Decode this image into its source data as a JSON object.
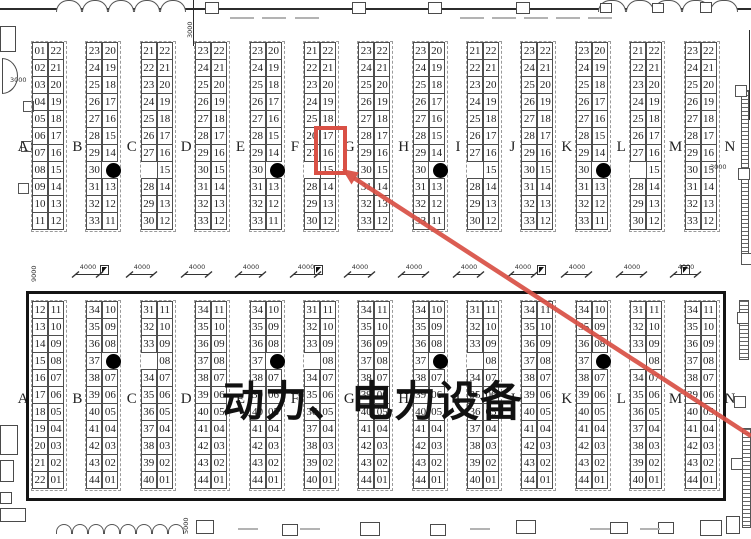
{
  "title": "动力、电力设备",
  "colors": {
    "highlight_red": "#d95045",
    "line_black": "#141414"
  },
  "row_letters": [
    "A",
    "B",
    "C",
    "D",
    "E",
    "F",
    "G",
    "H",
    "I",
    "J",
    "K",
    "L",
    "M",
    "N"
  ],
  "aisle": {
    "ramp_label": "4000",
    "ramp_count": 12
  },
  "dimension_labels": {
    "top_left_vertical": "3000",
    "left_wall": "3000",
    "left_height_vertical": "9000",
    "right_wall": "3000",
    "bottom_vertical": "5000"
  },
  "highlight": {
    "section": "top",
    "column_index": 6,
    "side": "right",
    "rows": [
      6,
      7
    ],
    "booths": [
      "17",
      "16"
    ]
  },
  "top_section": {
    "columns": [
      {
        "left": [
          "01",
          "02",
          "03",
          "04",
          "05",
          "06",
          "07",
          "08",
          "09",
          "10",
          "11"
        ],
        "right": [
          "22",
          "21",
          "20",
          "19",
          "18",
          "17",
          "16",
          "15",
          "14",
          "13",
          "12"
        ]
      },
      {
        "left": [
          "23",
          "24",
          "25",
          "26",
          "27",
          "28",
          "29",
          "30",
          "31",
          "32",
          "33"
        ],
        "right": [
          "20",
          "19",
          "18",
          "17",
          "16",
          "15",
          "14",
          "dot",
          "13",
          "12",
          "11"
        ]
      },
      {
        "left": [
          "21",
          "22",
          "23",
          "24",
          "25",
          "26",
          "27",
          "",
          "28",
          "29",
          "30"
        ],
        "right": [
          "22",
          "21",
          "20",
          "19",
          "18",
          "17",
          "16",
          "15",
          "14",
          "13",
          "12"
        ]
      },
      {
        "left": [
          "23",
          "24",
          "25",
          "26",
          "27",
          "28",
          "29",
          "30",
          "31",
          "32",
          "33"
        ],
        "right": [
          "22",
          "21",
          "20",
          "19",
          "18",
          "17",
          "16",
          "15",
          "14",
          "13",
          "12"
        ]
      },
      {
        "left": [
          "23",
          "24",
          "25",
          "26",
          "27",
          "28",
          "29",
          "30",
          "31",
          "32",
          "33"
        ],
        "right": [
          "20",
          "19",
          "18",
          "17",
          "16",
          "15",
          "14",
          "dot",
          "13",
          "12",
          "11"
        ]
      },
      {
        "left": [
          "21",
          "22",
          "23",
          "24",
          "25",
          "26",
          "27",
          "",
          "28",
          "29",
          "30"
        ],
        "right": [
          "22",
          "21",
          "20",
          "19",
          "18",
          "17",
          "16",
          "15",
          "14",
          "13",
          "12"
        ]
      },
      {
        "left": [
          "23",
          "24",
          "25",
          "26",
          "27",
          "28",
          "29",
          "30",
          "31",
          "32",
          "33"
        ],
        "right": [
          "22",
          "21",
          "20",
          "19",
          "18",
          "17",
          "16",
          "15",
          "14",
          "13",
          "12"
        ]
      },
      {
        "left": [
          "23",
          "24",
          "25",
          "26",
          "27",
          "28",
          "29",
          "30",
          "31",
          "32",
          "33"
        ],
        "right": [
          "20",
          "19",
          "18",
          "17",
          "16",
          "15",
          "14",
          "dot",
          "13",
          "12",
          "11"
        ]
      },
      {
        "left": [
          "21",
          "22",
          "23",
          "24",
          "25",
          "26",
          "27",
          "",
          "28",
          "29",
          "30"
        ],
        "right": [
          "22",
          "21",
          "20",
          "19",
          "18",
          "17",
          "16",
          "15",
          "14",
          "13",
          "12"
        ]
      },
      {
        "left": [
          "23",
          "24",
          "25",
          "26",
          "27",
          "28",
          "29",
          "30",
          "31",
          "32",
          "33"
        ],
        "right": [
          "22",
          "21",
          "20",
          "19",
          "18",
          "17",
          "16",
          "15",
          "14",
          "13",
          "12"
        ]
      },
      {
        "left": [
          "23",
          "24",
          "25",
          "26",
          "27",
          "28",
          "29",
          "30",
          "31",
          "32",
          "33"
        ],
        "right": [
          "20",
          "19",
          "18",
          "17",
          "16",
          "15",
          "14",
          "dot",
          "13",
          "12",
          "11"
        ]
      },
      {
        "left": [
          "21",
          "22",
          "23",
          "24",
          "25",
          "26",
          "27",
          "",
          "28",
          "29",
          "30"
        ],
        "right": [
          "22",
          "21",
          "20",
          "19",
          "18",
          "17",
          "16",
          "15",
          "14",
          "13",
          "12"
        ]
      },
      {
        "left": [
          "23",
          "24",
          "25",
          "26",
          "27",
          "28",
          "29",
          "30",
          "31",
          "32",
          "33"
        ],
        "right": [
          "22",
          "21",
          "20",
          "19",
          "18",
          "17",
          "16",
          "15",
          "14",
          "13",
          "12"
        ]
      }
    ]
  },
  "bottom_section": {
    "columns": [
      {
        "left": [
          "12",
          "13",
          "14",
          "15",
          "16",
          "17",
          "18",
          "19",
          "20",
          "21",
          "22"
        ],
        "right": [
          "11",
          "10",
          "09",
          "08",
          "07",
          "06",
          "05",
          "04",
          "03",
          "02",
          "01"
        ]
      },
      {
        "left": [
          "34",
          "35",
          "36",
          "37",
          "38",
          "39",
          "40",
          "41",
          "42",
          "43",
          "44"
        ],
        "right": [
          "10",
          "09",
          "08",
          "dot",
          "07",
          "06",
          "05",
          "04",
          "03",
          "02",
          "01"
        ]
      },
      {
        "left": [
          "31",
          "32",
          "33",
          "",
          "34",
          "35",
          "36",
          "37",
          "38",
          "39",
          "40"
        ],
        "right": [
          "11",
          "10",
          "09",
          "08",
          "07",
          "06",
          "05",
          "04",
          "03",
          "02",
          "01"
        ]
      },
      {
        "left": [
          "34",
          "35",
          "36",
          "37",
          "38",
          "39",
          "40",
          "41",
          "42",
          "43",
          "44"
        ],
        "right": [
          "11",
          "10",
          "09",
          "08",
          "07",
          "06",
          "05",
          "04",
          "03",
          "02",
          "01"
        ]
      },
      {
        "left": [
          "34",
          "35",
          "36",
          "37",
          "38",
          "39",
          "40",
          "41",
          "42",
          "43",
          "44"
        ],
        "right": [
          "10",
          "09",
          "08",
          "dot",
          "07",
          "06",
          "05",
          "04",
          "03",
          "02",
          "01"
        ]
      },
      {
        "left": [
          "31",
          "32",
          "33",
          "",
          "34",
          "35",
          "36",
          "37",
          "38",
          "39",
          "40"
        ],
        "right": [
          "11",
          "10",
          "09",
          "08",
          "07",
          "06",
          "05",
          "04",
          "03",
          "02",
          "01"
        ]
      },
      {
        "left": [
          "34",
          "35",
          "36",
          "37",
          "38",
          "39",
          "40",
          "41",
          "42",
          "43",
          "44"
        ],
        "right": [
          "11",
          "10",
          "09",
          "08",
          "07",
          "06",
          "05",
          "04",
          "03",
          "02",
          "01"
        ]
      },
      {
        "left": [
          "34",
          "35",
          "36",
          "37",
          "38",
          "39",
          "40",
          "41",
          "42",
          "43",
          "44"
        ],
        "right": [
          "10",
          "09",
          "08",
          "dot",
          "07",
          "06",
          "05",
          "04",
          "03",
          "02",
          "01"
        ]
      },
      {
        "left": [
          "31",
          "32",
          "33",
          "",
          "34",
          "35",
          "36",
          "37",
          "38",
          "39",
          "40"
        ],
        "right": [
          "11",
          "10",
          "09",
          "08",
          "07",
          "06",
          "05",
          "04",
          "03",
          "02",
          "01"
        ]
      },
      {
        "left": [
          "34",
          "35",
          "36",
          "37",
          "38",
          "39",
          "40",
          "41",
          "42",
          "43",
          "44"
        ],
        "right": [
          "11",
          "10",
          "09",
          "08",
          "07",
          "06",
          "05",
          "04",
          "03",
          "02",
          "01"
        ]
      },
      {
        "left": [
          "34",
          "35",
          "36",
          "37",
          "38",
          "39",
          "40",
          "41",
          "42",
          "43",
          "44"
        ],
        "right": [
          "10",
          "09",
          "08",
          "dot",
          "07",
          "06",
          "05",
          "04",
          "03",
          "02",
          "01"
        ]
      },
      {
        "left": [
          "31",
          "32",
          "33",
          "",
          "34",
          "35",
          "36",
          "37",
          "38",
          "39",
          "40"
        ],
        "right": [
          "11",
          "10",
          "09",
          "08",
          "07",
          "06",
          "05",
          "04",
          "03",
          "02",
          "01"
        ]
      },
      {
        "left": [
          "34",
          "35",
          "36",
          "37",
          "38",
          "39",
          "40",
          "41",
          "42",
          "43",
          "44"
        ],
        "right": [
          "11",
          "10",
          "09",
          "08",
          "07",
          "06",
          "05",
          "04",
          "03",
          "02",
          "01"
        ]
      }
    ]
  }
}
